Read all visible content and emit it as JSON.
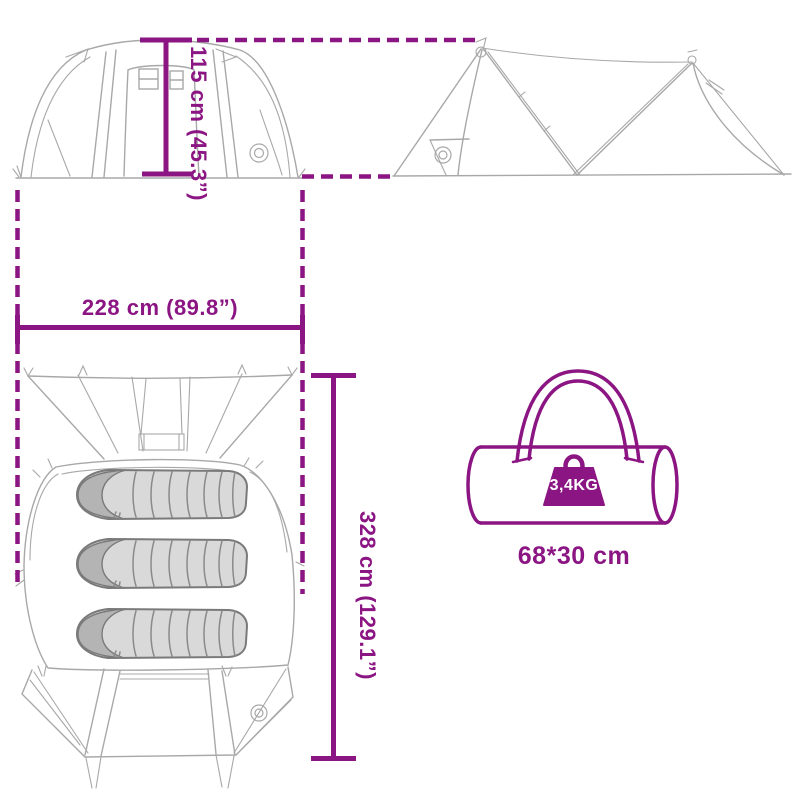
{
  "colors": {
    "accent": "#8B1582",
    "line_art": "#A8A8A8",
    "line_art_dark": "#8A8A8A",
    "bag_fill": "#D9D9D9",
    "bag_hood": "#B4B4B4",
    "background": "#FFFFFF",
    "weight_label_text": "#FFFFFF"
  },
  "dimensions": {
    "height_label": "115 cm (45.3”)",
    "width_label": "228 cm (89.8”)",
    "depth_label": "328 cm (129.1”)"
  },
  "carry_bag": {
    "weight_label": "3,4KG",
    "size_label": "68*30 cm"
  },
  "icons": {
    "front_view": "tent-front-view-drawing",
    "side_view": "tent-side-view-drawing",
    "top_view": "tent-top-view-drawing",
    "sleeping_bag": "sleeping-bag-icon",
    "carry_bag": "carry-bag-icon",
    "weight": "weight-icon",
    "brand_logo": "brand-logo-icon"
  }
}
